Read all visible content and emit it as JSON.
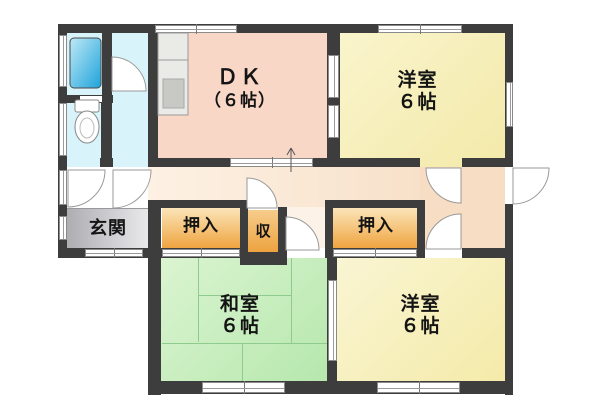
{
  "floorplan": {
    "kind": "japanese-apartment-floor-plan",
    "rooms": {
      "dk": {
        "line1": "ＤＫ",
        "line2": "（６帖）"
      },
      "western_top": {
        "line1": "洋室",
        "line2": "６帖"
      },
      "western_bottom": {
        "line1": "洋室",
        "line2": "６帖"
      },
      "japanese": {
        "line1": "和室",
        "line2": "６帖"
      },
      "entrance": {
        "label": "玄関"
      },
      "closet_left": {
        "label": "押入"
      },
      "closet_right": {
        "label": "押入"
      },
      "storage": {
        "label": "収"
      }
    },
    "colors": {
      "wall": "#3d3d3d",
      "dk": "#f8d7c7",
      "western_room": "#f5eeb8",
      "japanese_room": "#c5ecba",
      "hallway": "#f7ddc4",
      "closet_top": "#fbe5b9",
      "closet_bottom": "#efa440",
      "entrance_gray": "#b3b3b7",
      "bathroom": "#d9f3fa",
      "bathtub_blue": "#28a7dc",
      "tatami_line": "#8fcb8f"
    }
  }
}
